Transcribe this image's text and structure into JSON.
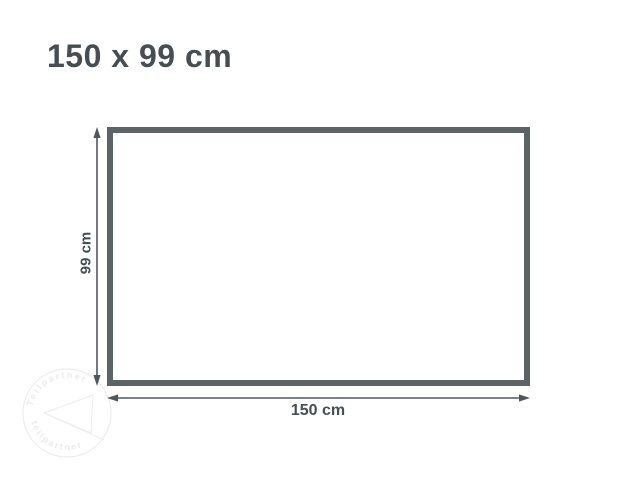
{
  "title": "150 x 99 cm",
  "diagram": {
    "height_label": "99 cm",
    "width_label": "150 cm"
  },
  "watermark": {
    "text_top": "Teilpartner",
    "text_bottom": "teilpartner"
  },
  "colors": {
    "background": "#ffffff",
    "title_text": "#464e53",
    "rectangle_border": "#5b6365",
    "dimension_line": "#4e585a",
    "label_text": "#464e53",
    "watermark": "#8a9094"
  }
}
